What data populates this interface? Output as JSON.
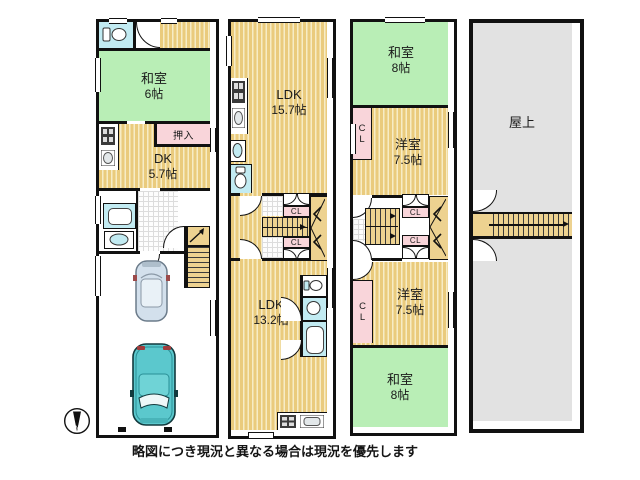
{
  "caption": "略図につき現況と異なる場合は現況を優先します",
  "compass": {
    "letter": "N"
  },
  "colors": {
    "wall": "#111111",
    "tatami_room_green": "#b9eeb6",
    "wood_floor_tan": "#eacb7d",
    "wood_floor_light": "#f7ecc6",
    "closet_pink": "#f9d5da",
    "fixture_blue": "#c2ebf2",
    "rooftop_gray": "#e2e2e2",
    "car_teal": "#5bc8cd",
    "car_pale": "#d3e0ec"
  },
  "rooms": {
    "f1_washitsu": {
      "name": "和室",
      "size": "6帖"
    },
    "f1_oshiire": {
      "label": "押入"
    },
    "f1_dk": {
      "name": "DK",
      "size": "5.7帖"
    },
    "f2_ldk_upper": {
      "name": "LDK",
      "size": "15.7帖"
    },
    "f2_cl_top": {
      "label": "CL"
    },
    "f2_cl_bottom": {
      "label": "CL"
    },
    "f2_ldk_lower": {
      "name": "LDK",
      "size": "13.2帖"
    },
    "f3_washitsu_top": {
      "name": "和室",
      "size": "8帖"
    },
    "f3_cl_upper": {
      "label": "CL"
    },
    "f3_yoshitsu_upper": {
      "name": "洋室",
      "size": "7.5帖"
    },
    "f3_cl_mid_top": {
      "label": "CL"
    },
    "f3_cl_mid_bottom": {
      "label": "CL"
    },
    "f3_cl_lower": {
      "label": "CL"
    },
    "f3_yoshitsu_lower": {
      "name": "洋室",
      "size": "7.5帖"
    },
    "f3_washitsu_bottom": {
      "name": "和室",
      "size": "8帖"
    },
    "roof": {
      "label": "屋上"
    }
  }
}
